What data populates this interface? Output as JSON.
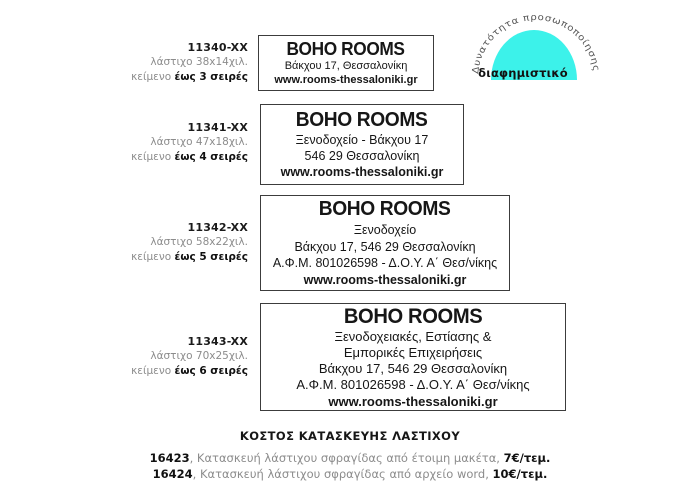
{
  "badge": {
    "arc_text": "Δυνατότητα προσωποποίησης",
    "label": "διαφημιστικό",
    "color": "#3CF2EA",
    "arc_text_color": "#555555",
    "label_color": "#121212"
  },
  "products": [
    {
      "code": "11340-XX",
      "size": "λάστιχο 38x14χιλ.",
      "note_prefix": "κείμενο",
      "note_bold": "έως 3 σειρές",
      "stamp": {
        "title": "BOHO ROOMS",
        "lines": [
          "Βάκχου 17, Θεσσαλονίκη"
        ],
        "website": "www.rooms-thessaloniki.gr"
      }
    },
    {
      "code": "11341-XX",
      "size": "λάστιχο 47x18χιλ.",
      "note_prefix": "κείμενο",
      "note_bold": "έως 4 σειρές",
      "stamp": {
        "title": "BOHO ROOMS",
        "lines": [
          "Ξενοδοχείο - Βάκχου 17",
          "546 29 Θεσσαλονίκη"
        ],
        "website": "www.rooms-thessaloniki.gr"
      }
    },
    {
      "code": "11342-XX",
      "size": "λάστιχο 58x22χιλ.",
      "note_prefix": "κείμενο",
      "note_bold": "έως 5 σειρές",
      "stamp": {
        "title": "BOHO ROOMS",
        "lines": [
          "Ξενοδοχείο",
          "Βάκχου 17, 546 29 Θεσσαλονίκη",
          "Α.Φ.Μ. 801026598 - Δ.Ο.Υ. Α΄ Θεσ/νίκης"
        ],
        "website": "www.rooms-thessaloniki.gr"
      }
    },
    {
      "code": "11343-XX",
      "size": "λάστιχο 70x25χιλ.",
      "note_prefix": "κείμενο",
      "note_bold": "έως 6 σειρές",
      "stamp": {
        "title": "BOHO ROOMS",
        "lines": [
          "Ξενοδοχειακές, Εστίασης &",
          "Εμπορικές Επιχειρήσεις",
          "Βάκχου 17, 546 29 Θεσσαλονίκη",
          "Α.Φ.Μ. 801026598 - Δ.Ο.Υ. Α΄ Θεσ/νίκης"
        ],
        "website": "www.rooms-thessaloniki.gr"
      }
    }
  ],
  "pricing": {
    "heading": "ΚΟΣΤΟΣ ΚΑΤΑΣΚΕΥΗΣ ΛΑΣΤΙΧΟΥ",
    "items": [
      {
        "code": "16423",
        "description": ", Κατασκευή λάστιχου σφραγίδας από έτοιμη μακέτα, ",
        "price": "7€/τεμ."
      },
      {
        "code": "16424",
        "description": ", Κατασκευή λάστιχου σφραγίδας από αρχείο word, ",
        "price": "10€/τεμ."
      }
    ]
  }
}
